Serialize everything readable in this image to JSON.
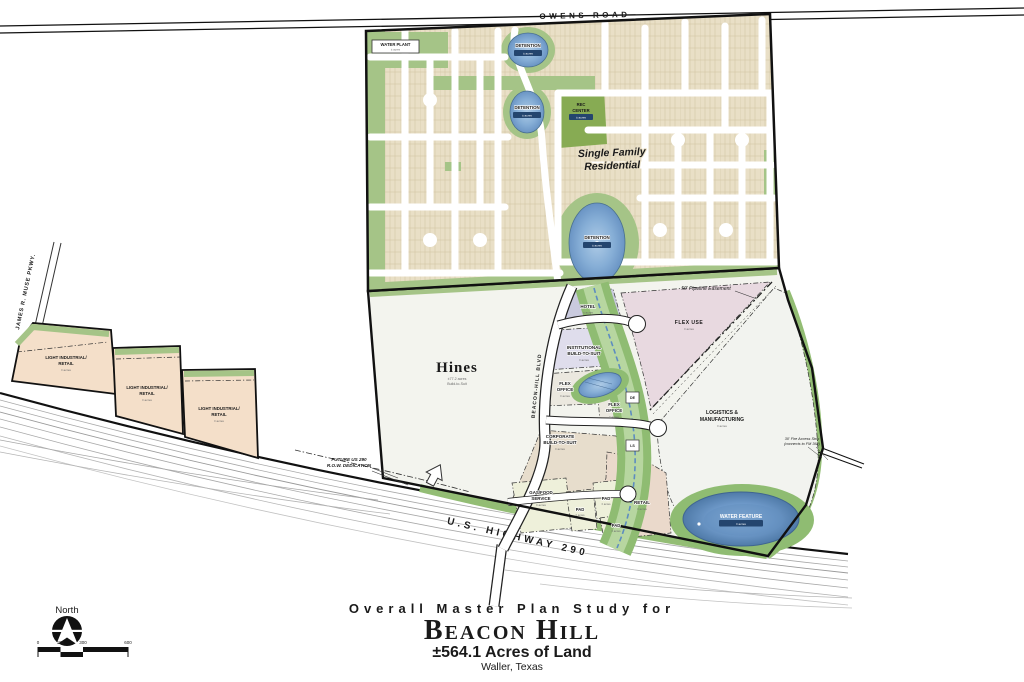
{
  "palette": {
    "residential_tan": "#e9dfc6",
    "green": "#a5c487",
    "corridor_green": "#8fbc72",
    "pond_blue": "#86aed6",
    "flex_use_pink": "#e8d9e0",
    "hotel_lavender": "#c9cade",
    "institutional_lavender": "#dfddec",
    "corporate_tan": "#e7ddcc",
    "retail_tan": "#ead9cb",
    "pad_cream": "#eef0da",
    "industrial_tan": "#f4dfc9",
    "hines_maroon": "#7c2f3e",
    "label_navy_chip": "#24456e"
  },
  "roads": {
    "owens_road": "OWENS ROAD",
    "james_muse_pkwy": "JAMES R. MUSE PKWY.",
    "beacon_hill_blvd": "BEACON-HILL BLVD",
    "us_highway_290": "U.S. HIGHWAY 290",
    "future_row_line1": "FUTURE US 290",
    "future_row_line2": "R.O.W. DEDICATION"
  },
  "residential": {
    "label_line1": "Single Family",
    "label_line2": "Residential",
    "water_plant": "WATER PLANT",
    "rec_center_line1": "REC",
    "rec_center_line2": "CENTER",
    "detention": "DETENTION"
  },
  "parcels": {
    "hines_name": "Hines",
    "hines_sub1": "±77.2 acres",
    "hines_sub2": "Build-to-Suit",
    "hotel": "HOTEL",
    "institutional_line1": "INSTITUTIONAL",
    "institutional_line2": "BUILD-TO-SUIT",
    "flex_office_line1": "FLEX",
    "flex_office_line2": "OFFICE",
    "flex_use": "FLEX USE",
    "logistics_line1": "LOGISTICS &",
    "logistics_line2": "MANUFACTURING",
    "corporate_line1": "CORPORATE",
    "corporate_line2": "BUILD-TO-SUIT",
    "gas_food_line1": "GAS/FOOD",
    "gas_food_line2": "SERVICE",
    "pad": "PAD",
    "retail": "RETAIL",
    "light_industrial_line1": "LIGHT INDUSTRIAL/",
    "light_industrial_line2": "RETAIL",
    "water_feature": "WATER FEATURE"
  },
  "annotations": {
    "pipeline_easement": "50' Pipeline Easement",
    "access_strip_line1": "30' Fire Access Strip",
    "access_strip_line2": "(connects to FM 362)",
    "de_marker": "DE",
    "ls_marker": "LS",
    "acres_note": "± acres"
  },
  "title_block": {
    "line1": "Overall Master Plan Study for",
    "line2": "Beacon Hill",
    "line3": "±564.1  Acres of Land",
    "line4": "Waller, Texas"
  },
  "compass": {
    "north": "North",
    "scale_0": "0",
    "scale_150": "150",
    "scale_300": "300",
    "scale_600": "600"
  }
}
